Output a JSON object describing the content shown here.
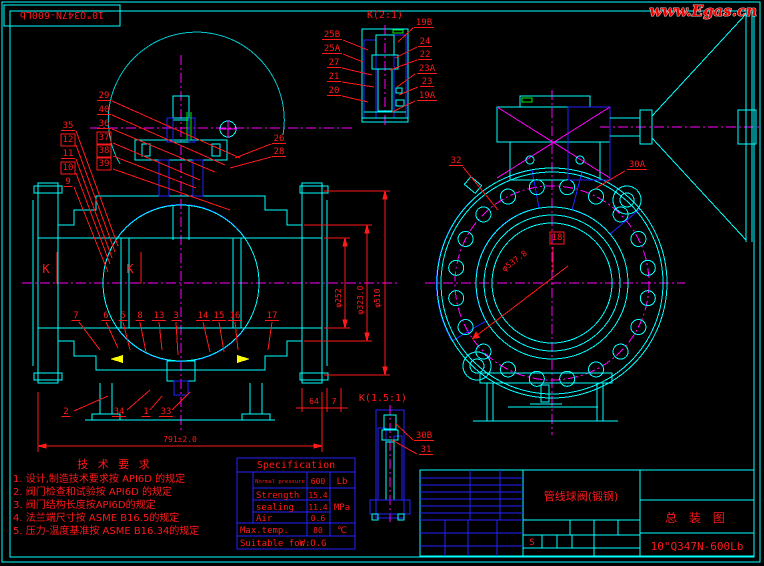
{
  "stamp": {
    "part_no": "10\"Q347N-600Lb"
  },
  "watermark": {
    "text": "www.Egas.cn"
  },
  "details": {
    "k2_title": "K(2:1)",
    "k15_title": "K(1.5:1)"
  },
  "tech": {
    "title": "技 术 要 求",
    "items": [
      "1. 设计,制造技术要求按 API6D 的规定",
      "2. 阀门检查和试验按 API6D 的规定",
      "3. 阀门结构长度按API6D的规定",
      "4. 法兰端尺寸按 ASME B16.5的规定",
      "5. 压力-温度基准按 ASME B16.34的规定"
    ]
  },
  "spec": {
    "title": "Specification",
    "pressure_label": "Normal pressure",
    "pressure_value": "600",
    "pressure_unit": "Lb",
    "strength_label": "Strength",
    "strength_value": "15.4",
    "sealing_label": "sealing",
    "sealing_value": "11.4",
    "air_label": "Air",
    "air_value": "0.6",
    "unit_mpa": "MPa",
    "maxtemp_label": "Max.temp.",
    "maxtemp_value": "80",
    "maxtemp_unit": "℃",
    "suitable_label": "Suitable for:",
    "suitable_value": "W.O.G"
  },
  "titleblock": {
    "name": "管线球阀(锻钢)",
    "drawing": "总 装 图",
    "model": "10\"Q347N-600Lb",
    "rev": "S"
  },
  "callouts": [
    {
      "t": "35",
      "x": 68,
      "y": 128,
      "leader": [
        76,
        131,
        118,
        246
      ]
    },
    {
      "t": "12",
      "x": 68,
      "y": 142,
      "box": true,
      "leader": [
        76,
        145,
        115,
        252
      ]
    },
    {
      "t": "11",
      "x": 68,
      "y": 156,
      "leader": [
        76,
        159,
        112,
        258
      ]
    },
    {
      "t": "10",
      "x": 68,
      "y": 170,
      "box": true,
      "leader": [
        76,
        173,
        110,
        264
      ]
    },
    {
      "t": "9",
      "x": 68,
      "y": 184,
      "leader": [
        74,
        187,
        108,
        272
      ]
    },
    {
      "t": "29",
      "x": 104,
      "y": 98,
      "leader": [
        112,
        101,
        240,
        158
      ]
    },
    {
      "t": "40",
      "x": 104,
      "y": 112,
      "leader": [
        112,
        115,
        225,
        165
      ]
    },
    {
      "t": "36",
      "x": 104,
      "y": 126,
      "leader": [
        112,
        129,
        215,
        172
      ]
    },
    {
      "t": "37",
      "x": 104,
      "y": 140,
      "box": true,
      "leader": [
        113,
        143,
        200,
        180
      ]
    },
    {
      "t": "38",
      "x": 104,
      "y": 153,
      "box": true,
      "leader": [
        113,
        156,
        196,
        188
      ]
    },
    {
      "t": "39",
      "x": 104,
      "y": 166,
      "box": true,
      "leader": [
        113,
        169,
        230,
        210
      ]
    },
    {
      "t": "26",
      "x": 279,
      "y": 141,
      "leader": [
        271,
        144,
        235,
        158
      ]
    },
    {
      "t": "28",
      "x": 279,
      "y": 154,
      "leader": [
        271,
        157,
        230,
        168
      ]
    },
    {
      "t": "7",
      "x": 76,
      "y": 318,
      "leader": [
        79,
        322,
        100,
        350
      ]
    },
    {
      "t": "6",
      "x": 106,
      "y": 318,
      "leader": [
        106,
        322,
        118,
        348
      ]
    },
    {
      "t": "5",
      "x": 123,
      "y": 318,
      "leader": [
        123,
        322,
        130,
        350
      ]
    },
    {
      "t": "8",
      "x": 140,
      "y": 318,
      "leader": [
        140,
        322,
        146,
        352
      ]
    },
    {
      "t": "13",
      "x": 159,
      "y": 318,
      "leader": [
        159,
        322,
        162,
        350
      ]
    },
    {
      "t": "3",
      "x": 176,
      "y": 318,
      "leader": [
        176,
        322,
        178,
        355
      ]
    },
    {
      "t": "14",
      "x": 203,
      "y": 318,
      "leader": [
        203,
        322,
        210,
        352
      ]
    },
    {
      "t": "15",
      "x": 219,
      "y": 318,
      "leader": [
        219,
        322,
        224,
        352
      ]
    },
    {
      "t": "16",
      "x": 235,
      "y": 318,
      "leader": [
        235,
        322,
        238,
        350
      ]
    },
    {
      "t": "17",
      "x": 272,
      "y": 318,
      "leader": [
        272,
        322,
        268,
        350
      ]
    },
    {
      "t": "2",
      "x": 66,
      "y": 414,
      "leader": [
        74,
        411,
        108,
        396
      ]
    },
    {
      "t": "34",
      "x": 119,
      "y": 414,
      "leader": [
        127,
        410,
        150,
        390
      ]
    },
    {
      "t": "1",
      "x": 146,
      "y": 414,
      "leader": [
        150,
        410,
        162,
        396
      ]
    },
    {
      "t": "33",
      "x": 166,
      "y": 414,
      "leader": [
        172,
        410,
        190,
        392
      ]
    },
    {
      "t": "25B",
      "x": 332,
      "y": 37,
      "leader": [
        343,
        40,
        368,
        50
      ]
    },
    {
      "t": "25A",
      "x": 332,
      "y": 51,
      "leader": [
        343,
        54,
        363,
        62
      ]
    },
    {
      "t": "27",
      "x": 334,
      "y": 65,
      "leader": [
        342,
        68,
        372,
        75
      ]
    },
    {
      "t": "21",
      "x": 334,
      "y": 79,
      "leader": [
        342,
        82,
        374,
        87
      ]
    },
    {
      "t": "20",
      "x": 334,
      "y": 93,
      "leader": [
        342,
        96,
        368,
        102
      ]
    },
    {
      "t": "19B",
      "x": 424,
      "y": 25,
      "leader": [
        413,
        28,
        398,
        42
      ]
    },
    {
      "t": "24",
      "x": 425,
      "y": 44,
      "leader": [
        417,
        47,
        395,
        58
      ]
    },
    {
      "t": "22",
      "x": 425,
      "y": 57,
      "leader": [
        417,
        60,
        390,
        70
      ]
    },
    {
      "t": "23A",
      "x": 427,
      "y": 71,
      "leader": [
        415,
        74,
        397,
        87
      ]
    },
    {
      "t": "23",
      "x": 427,
      "y": 84,
      "leader": [
        418,
        87,
        399,
        95
      ]
    },
    {
      "t": "19A",
      "x": 427,
      "y": 98,
      "leader": [
        415,
        101,
        392,
        112
      ]
    },
    {
      "t": "30B",
      "x": 424,
      "y": 438,
      "leader": [
        413,
        440,
        396,
        424
      ]
    },
    {
      "t": "31",
      "x": 426,
      "y": 452,
      "leader": [
        417,
        454,
        392,
        440
      ]
    },
    {
      "t": "32",
      "x": 456,
      "y": 163,
      "leader": [
        463,
        167,
        498,
        210
      ]
    },
    {
      "t": "30A",
      "x": 637,
      "y": 167,
      "leader": [
        625,
        171,
        596,
        188
      ]
    },
    {
      "t": "18",
      "x": 557,
      "y": 240,
      "box": true,
      "leader": [
        553,
        247,
        553,
        272
      ]
    },
    {
      "t": "K",
      "x": 46,
      "y": 273,
      "ul": false,
      "fs": 12,
      "leader": [
        57,
        252,
        57,
        284
      ]
    },
    {
      "t": "K",
      "x": 130,
      "y": 273,
      "ul": false,
      "fs": 12,
      "leader": [
        141,
        252,
        141,
        284
      ]
    }
  ],
  "dimensions": [
    {
      "t": "791±2.0",
      "x": 180,
      "y": 442
    },
    {
      "t": "φ252",
      "x": 341,
      "y": 298,
      "r": -90
    },
    {
      "t": "φ323.0",
      "x": 363,
      "y": 300,
      "r": -90
    },
    {
      "t": "φ510",
      "x": 380,
      "y": 298,
      "r": -90
    },
    {
      "t": "64",
      "x": 314,
      "y": 404
    },
    {
      "t": "7",
      "x": 334,
      "y": 404
    },
    {
      "t": "φ537.8",
      "x": 516,
      "y": 263,
      "r": -37
    }
  ]
}
